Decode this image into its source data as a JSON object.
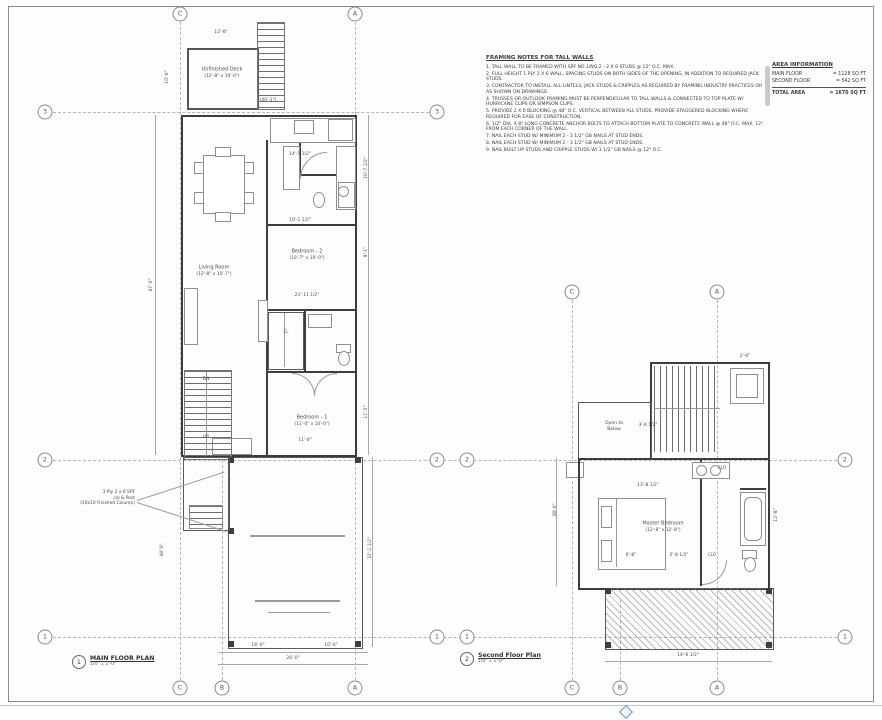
{
  "notes": {
    "title": "FRAMING NOTES FOR TALL WALLS",
    "items": [
      "1.  TALL WALL TO BE FRAMED WITH SPF NO.1/NO.2 - 2 X 6 STUDS @ 12\" O.C. MAX.",
      "2.  FULL HEIGHT 1 PLY 2 X 6 WALL, SPACING STUDS ON BOTH SIDES OF THE OPENING, IN ADDITION TO REQUIRED JACK STUDS.",
      "3.  CONTRACTOR TO INSTALL ALL LINTELS, JACK STUDS & CRIPPLES AS REQUIRED BY FRAMING INDUSTRY PRACTICES OR AS SHOWN ON DRAWINGS.",
      "4.  TRUSSES OR OUTLOOK FRAMING MUST BE PERPENDICULAR TO TALL WALLS & CONNECTED TO TOP PLATE W/ HURRICANE CLIPS OR SIMPSON CLIPS.",
      "5.  PROVIDE 2 X 6 BLOCKING @ 48\" O.C. VERTICAL BETWEEN ALL STUDS. PROVIDE STAGGERED BLOCKING WHERE REQUIRED FOR EASE OF CONSTRUCTION.",
      "6.  1/2\" DIA. X 8\" LONG CONCRETE ANCHOR BOLTS TO ATTACH BOTTOM PLATE TO CONCRETE WALL @ 48\" O.C. MAX. 12\" FROM EACH CORNER OF THE WALL.",
      "7.  NAIL EACH STUD W/ MINIMUM 2 - 3 1/2\" GB NAILS AT STUD ENDS.",
      "8.  NAIL EACH STUD W/ MINIMUM 2 - 3 1/2\" GB NAILS AT STUD ENDS.",
      "9.  NAIL BUILT UP STUDS AND CRIPPLE STUDS W/ 3 1/2\" GB NAILS @ 12\" O.C."
    ]
  },
  "area_table": {
    "title": "AREA INFORMATION",
    "rows": [
      {
        "label": "MAIN FLOOR",
        "value": "= 1128 SQ FT"
      },
      {
        "label": "SECOND FLOOR",
        "value": "= 542 SQ FT"
      },
      {
        "label": "TOTAL AREA",
        "value": "= 1670 SQ FT"
      }
    ]
  },
  "main_plan": {
    "number": "1",
    "title": "MAIN FLOOR PLAN",
    "scale": "1/4\" = 1'-0\"",
    "callout": [
      "3 Ply 2 x 6 SPF",
      "col & Post",
      "(10x10 Finished Column)"
    ]
  },
  "second_plan": {
    "number": "2",
    "title": "Second Floor Plan",
    "scale": "1/4\" = 1'-0\""
  },
  "room_labels": [
    {
      "t": "Unfinished Deck",
      "x": 222,
      "y": 70,
      "s": 5
    },
    {
      "t": "(12'-8\" x 10'-0\")",
      "x": 222,
      "y": 77,
      "s": 4.4
    },
    {
      "t": "Living Room",
      "x": 214,
      "y": 268,
      "s": 5
    },
    {
      "t": "(12'-8\" x 15'-7\")",
      "x": 214,
      "y": 275,
      "s": 4.4
    },
    {
      "t": "Bedroom - 2",
      "x": 307,
      "y": 252,
      "s": 5
    },
    {
      "t": "(10'-7\" x 10'-0\")",
      "x": 307,
      "y": 259,
      "s": 4.4
    },
    {
      "t": "Bedroom - 1",
      "x": 312,
      "y": 418,
      "s": 5
    },
    {
      "t": "(11'-0\" x 10'-0\")",
      "x": 312,
      "y": 425,
      "s": 4.4
    },
    {
      "t": "DN",
      "x": 206,
      "y": 380,
      "s": 4.4
    },
    {
      "t": "UP",
      "x": 206,
      "y": 438,
      "s": 4.4
    },
    {
      "t": "CL",
      "x": 286,
      "y": 332,
      "s": 4
    },
    {
      "t": "Open to",
      "x": 614,
      "y": 424,
      "s": 4.5
    },
    {
      "t": "Below",
      "x": 614,
      "y": 430,
      "s": 4.5
    },
    {
      "t": "Master Bedroom",
      "x": 663,
      "y": 524,
      "s": 5
    },
    {
      "t": "(12'-8\" x 12'-8\")",
      "x": 663,
      "y": 531,
      "s": 4.4
    },
    {
      "t": "CLO",
      "x": 722,
      "y": 468,
      "s": 4
    },
    {
      "t": "CLO",
      "x": 712,
      "y": 555,
      "s": 4
    }
  ],
  "dim_labels": [
    {
      "t": "(40'-1\")",
      "x": 268,
      "y": 101,
      "s": 4.4
    },
    {
      "t": "12'-8\"",
      "x": 221,
      "y": 33,
      "s": 4.4
    },
    {
      "t": "14'-5 1/2\"",
      "x": 300,
      "y": 155,
      "s": 4.4
    },
    {
      "t": "10'-1 1/2\"",
      "x": 300,
      "y": 221,
      "s": 4.4
    },
    {
      "t": "21'-11 1/2\"",
      "x": 307,
      "y": 296,
      "s": 4.4
    },
    {
      "t": "11'-0\"",
      "x": 305,
      "y": 441,
      "s": 4.4
    },
    {
      "t": "16'-0\"",
      "x": 258,
      "y": 646,
      "s": 4.4
    },
    {
      "t": "10'-0\"",
      "x": 331,
      "y": 646,
      "s": 4.4
    },
    {
      "t": "26'-0\"",
      "x": 293,
      "y": 659,
      "s": 4.4
    },
    {
      "t": "47'-0\"",
      "x": 152,
      "y": 285,
      "s": 4.4,
      "r": -90
    },
    {
      "t": "44'-0\"",
      "x": 163,
      "y": 550,
      "s": 4.4,
      "r": -90
    },
    {
      "t": "31'-1 1/2\"",
      "x": 371,
      "y": 548,
      "s": 4.4,
      "r": -90
    },
    {
      "t": "10'-7 1/2\"",
      "x": 367,
      "y": 168,
      "s": 4.4,
      "r": -90
    },
    {
      "t": "9'-1\"",
      "x": 367,
      "y": 252,
      "s": 4.4,
      "r": -90
    },
    {
      "t": "11'-5\"",
      "x": 367,
      "y": 412,
      "s": 4.4,
      "r": -90
    },
    {
      "t": "10'-0\"",
      "x": 168,
      "y": 77,
      "s": 4.4,
      "r": -90
    },
    {
      "t": "13'-8 1/2\"",
      "x": 648,
      "y": 486,
      "s": 4.4
    },
    {
      "t": "3'-6 1/2\"",
      "x": 648,
      "y": 426,
      "s": 4.4
    },
    {
      "t": "6'-8\"",
      "x": 631,
      "y": 556,
      "s": 4.4
    },
    {
      "t": "5'-8 1/2\"",
      "x": 679,
      "y": 556,
      "s": 4.4
    },
    {
      "t": "38'-0\"",
      "x": 556,
      "y": 510,
      "s": 4.4,
      "r": -90
    },
    {
      "t": "12'-8\"",
      "x": 777,
      "y": 515,
      "s": 4.4,
      "r": -90
    },
    {
      "t": "14'-6 1/2\"",
      "x": 688,
      "y": 656,
      "s": 4.4
    },
    {
      "t": "2'-6\"",
      "x": 745,
      "y": 357,
      "s": 4.4
    }
  ],
  "grid_bubbles": [
    {
      "l": "C",
      "x": 180,
      "y": 14
    },
    {
      "l": "A",
      "x": 355,
      "y": 14
    },
    {
      "l": "3",
      "x": 45,
      "y": 112
    },
    {
      "l": "2",
      "x": 45,
      "y": 460
    },
    {
      "l": "1",
      "x": 45,
      "y": 637
    },
    {
      "l": "3",
      "x": 437,
      "y": 112
    },
    {
      "l": "2",
      "x": 437,
      "y": 460
    },
    {
      "l": "1",
      "x": 437,
      "y": 637
    },
    {
      "l": "C",
      "x": 180,
      "y": 688
    },
    {
      "l": "B",
      "x": 222,
      "y": 688
    },
    {
      "l": "A",
      "x": 355,
      "y": 688
    },
    {
      "l": "C",
      "x": 572,
      "y": 292
    },
    {
      "l": "A",
      "x": 717,
      "y": 292
    },
    {
      "l": "2",
      "x": 467,
      "y": 460
    },
    {
      "l": "1",
      "x": 467,
      "y": 637
    },
    {
      "l": "2",
      "x": 845,
      "y": 460
    },
    {
      "l": "1",
      "x": 845,
      "y": 637
    },
    {
      "l": "C",
      "x": 572,
      "y": 688
    },
    {
      "l": "B",
      "x": 620,
      "y": 688
    },
    {
      "l": "A",
      "x": 717,
      "y": 688
    }
  ]
}
